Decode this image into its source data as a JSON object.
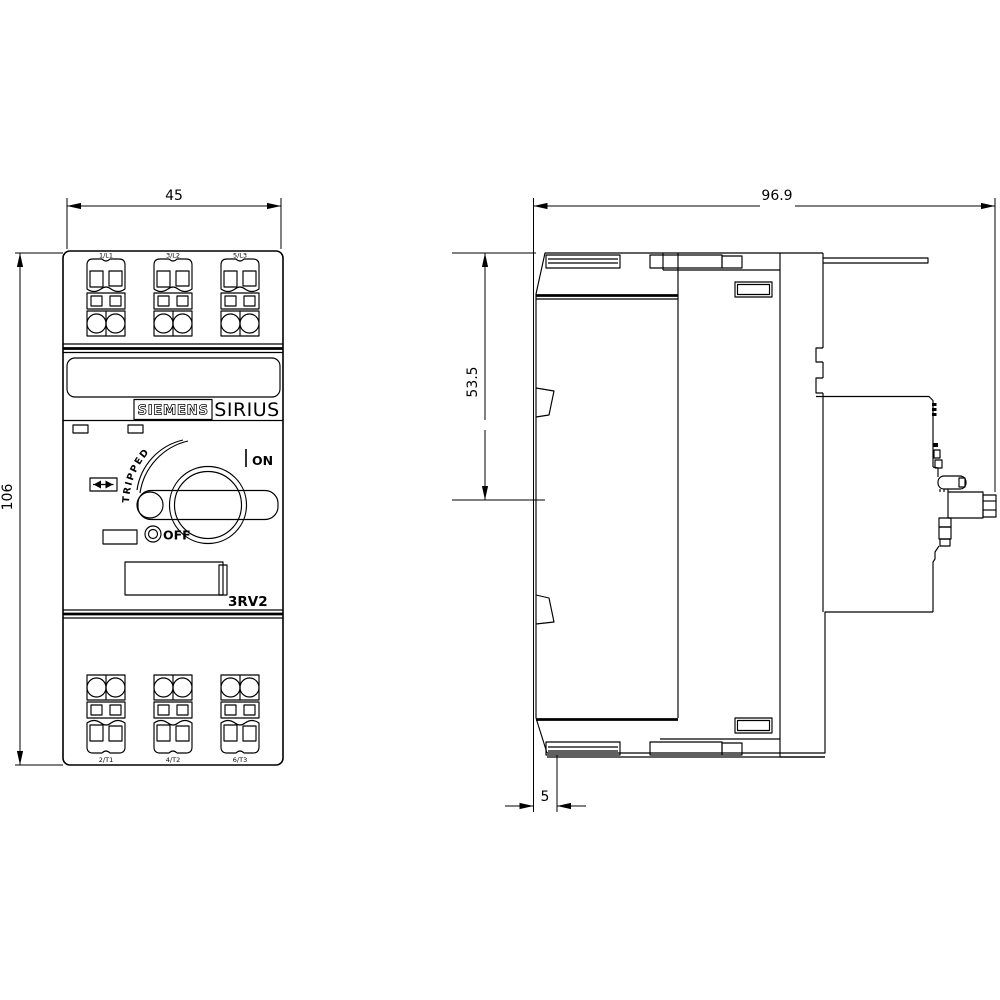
{
  "drawing": {
    "type": "dimensional-drawing",
    "views": [
      "front",
      "side"
    ],
    "front_view": {
      "brand": "SIEMENS",
      "series": "SIRIUS",
      "model": "3RV2",
      "switch": {
        "tripped": "TRIPPED",
        "on": "ON",
        "off": "OFF"
      },
      "terminals": {
        "top": [
          "1/L1",
          "3/L2",
          "5/L3"
        ],
        "bottom": [
          "2/T1",
          "4/T2",
          "6/T3"
        ]
      }
    },
    "dimensions": {
      "front_width": "45",
      "front_height": "106",
      "side_depth": "96.9",
      "side_upper_height": "53.5",
      "side_foot_depth": "5"
    },
    "icons": {
      "trip_indicator": "bowtie-zigzag-window",
      "rotary_knob": "circular-knob-with-lever",
      "off_marker": "small-double-circle",
      "on_marker": "vertical-tick"
    },
    "colors": {
      "line": "#000000",
      "background": "#ffffff"
    }
  }
}
